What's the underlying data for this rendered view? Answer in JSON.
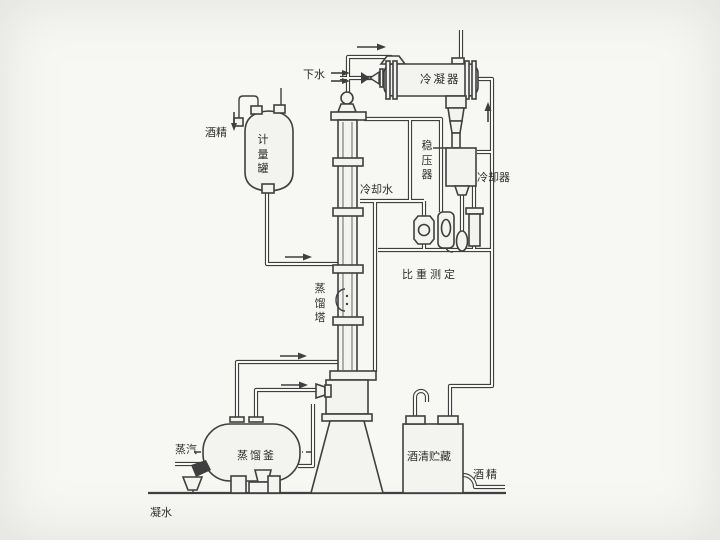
{
  "diagram": {
    "title": "Alcohol distillation process flow diagram",
    "labels": {
      "drain_water": "下水",
      "condenser": "冷凝器",
      "stabilizer": "稳压器",
      "cooling_water": "冷却水",
      "cooler": "冷却器",
      "gravity_measure": "比重测定",
      "alcohol_feed": "酒精",
      "measuring_tank": "计量罐",
      "tower": "蒸馏塔",
      "steam": "蒸汽",
      "pot": "蒸馏釜",
      "condensate": "凝水",
      "storage": "酒清贮藏",
      "alcohol_out": "酒精"
    },
    "colors": {
      "line": "#3f3f3f",
      "paper": "#f7f7f4",
      "vessel_fill": "#f3f4f0"
    }
  }
}
